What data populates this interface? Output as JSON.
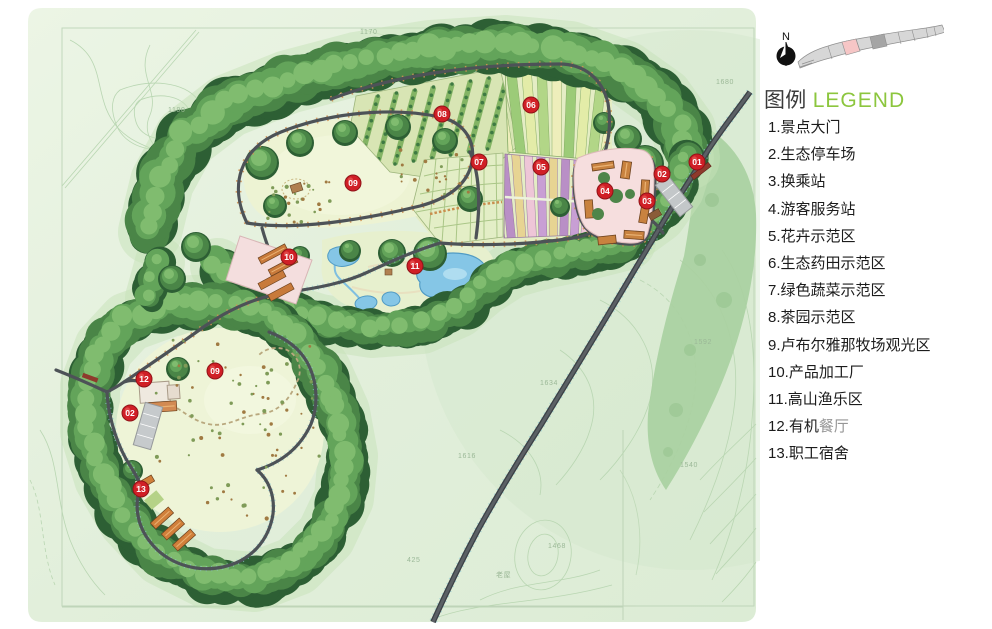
{
  "compass": {
    "label": "N"
  },
  "legend": {
    "title_zh": "图例",
    "title_en": "LEGEND",
    "accent_color": "#8cc63e",
    "items": [
      {
        "text": "1.景点大门"
      },
      {
        "text": "2.生态停车场"
      },
      {
        "text": "3.换乘站"
      },
      {
        "text": "4.游客服务站"
      },
      {
        "text": "5.花卉示范区"
      },
      {
        "text": "6.生态药田示范区"
      },
      {
        "text": "7.绿色蔬菜示范区"
      },
      {
        "text": "8.茶园示范区"
      },
      {
        "text": "9.卢布尔雅那牧场观光区"
      },
      {
        "text": "10.产品加工厂"
      },
      {
        "text": "11.高山渔乐区"
      },
      {
        "text": "12.有机",
        "muted": "餐厅"
      },
      {
        "text": "13.职工宿舍"
      }
    ]
  },
  "map": {
    "marker_color": "#d01f26",
    "markers": [
      {
        "label": "01",
        "x": 697,
        "y": 162,
        "name": "scenic-gate"
      },
      {
        "label": "02",
        "x": 662,
        "y": 174,
        "name": "eco-parking-east"
      },
      {
        "label": "03",
        "x": 647,
        "y": 201,
        "name": "transfer-station"
      },
      {
        "label": "04",
        "x": 605,
        "y": 191,
        "name": "visitor-service-station"
      },
      {
        "label": "05",
        "x": 541,
        "y": 167,
        "name": "flower-demo-zone"
      },
      {
        "label": "06",
        "x": 531,
        "y": 105,
        "name": "herb-field-demo-zone"
      },
      {
        "label": "07",
        "x": 479,
        "y": 162,
        "name": "vegetable-demo-zone"
      },
      {
        "label": "08",
        "x": 442,
        "y": 114,
        "name": "tea-garden-demo-zone"
      },
      {
        "label": "09",
        "x": 353,
        "y": 183,
        "name": "pasture-zone-upper"
      },
      {
        "label": "09",
        "x": 215,
        "y": 371,
        "name": "pasture-zone-lower"
      },
      {
        "label": "10",
        "x": 289,
        "y": 257,
        "name": "processing-plant"
      },
      {
        "label": "11",
        "x": 415,
        "y": 266,
        "name": "alpine-fishing-zone"
      },
      {
        "label": "12",
        "x": 144,
        "y": 379,
        "name": "organic-restaurant"
      },
      {
        "label": "02",
        "x": 130,
        "y": 413,
        "name": "eco-parking-west"
      },
      {
        "label": "13",
        "x": 141,
        "y": 489,
        "name": "staff-dormitory"
      }
    ],
    "terrain_labels": [
      {
        "text": "1170",
        "x": 360,
        "y": 34
      },
      {
        "text": "1190",
        "x": 168,
        "y": 112
      },
      {
        "text": "1680",
        "x": 716,
        "y": 84
      },
      {
        "text": "1592",
        "x": 694,
        "y": 344
      },
      {
        "text": "1634",
        "x": 540,
        "y": 385
      },
      {
        "text": "1616",
        "x": 458,
        "y": 458
      },
      {
        "text": "1540",
        "x": 680,
        "y": 467
      },
      {
        "text": "1468",
        "x": 548,
        "y": 548
      },
      {
        "text": "425",
        "x": 407,
        "y": 562
      },
      {
        "text": "老屋",
        "x": 496,
        "y": 577
      }
    ]
  }
}
